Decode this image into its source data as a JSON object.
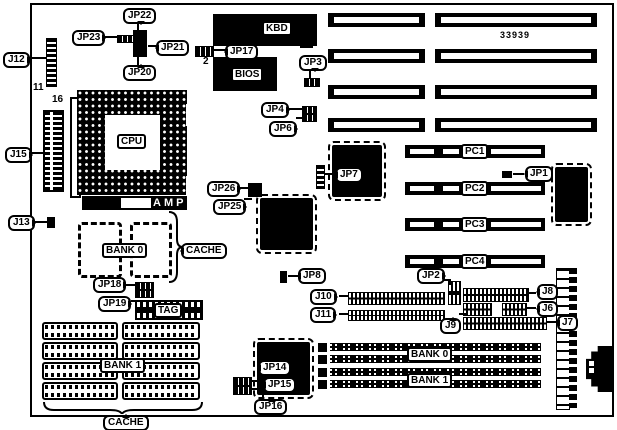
{
  "figure": {
    "part_number": "33939"
  },
  "callouts": {
    "j12": "J12",
    "j15": "J15",
    "j13": "J13",
    "jp22": "JP22",
    "jp23": "JP23",
    "jp21": "JP21",
    "jp20": "JP20",
    "jp17": "JP17",
    "jp3": "JP3",
    "jp4": "JP4",
    "jp6": "JP6",
    "jp26": "JP26",
    "jp25": "JP25",
    "jp7": "JP7",
    "jp1": "JP1",
    "jp2": "JP2",
    "jp8": "JP8",
    "j10": "J10",
    "j11": "J11",
    "j9": "J9",
    "j8": "J8",
    "j6": "J6",
    "j7": "J7",
    "jp18": "JP18",
    "jp19": "JP19",
    "jp14": "JP14",
    "jp15": "JP15",
    "jp16": "JP16"
  },
  "chips": {
    "kbd": "KBD",
    "bios": "BIOS",
    "cpu": "CPU",
    "amp": "AMP",
    "tag": "TAG"
  },
  "cache": {
    "sram_bank": "BANK 0",
    "dip_bank": "BANK 1",
    "label_top": "CACHE",
    "label_bottom": "CACHE"
  },
  "simm": {
    "bank0": "BANK 0",
    "bank1": "BANK 1"
  },
  "pci_slots": [
    {
      "label": "PC1"
    },
    {
      "label": "PC2"
    },
    {
      "label": "PC3"
    },
    {
      "label": "PC4"
    }
  ],
  "pins": {
    "j12_last": "11",
    "j15_first": "16",
    "jp17_pin2": "2"
  }
}
